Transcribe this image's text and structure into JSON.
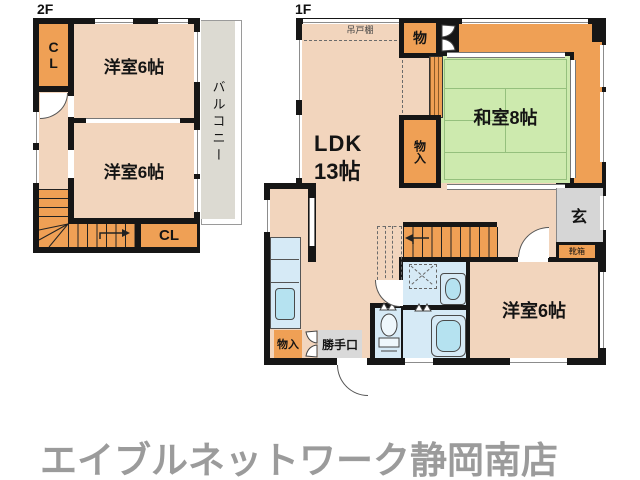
{
  "floor2": {
    "label": "2F",
    "closet_top": "CL",
    "room_top": "洋室6帖",
    "room_bottom": "洋室6帖",
    "closet_bottom": "CL",
    "balcony": "バルコニー"
  },
  "floor1": {
    "label": "1F",
    "ldk_name": "LDK",
    "ldk_size": "13帖",
    "hanging_cupboard": "吊戸棚",
    "storage_top": "物",
    "storage_mid": "物入",
    "japanese_room": "和室8帖",
    "entrance": "玄",
    "shoe_box": "靴箱",
    "western_room": "洋室6帖",
    "storage_bottom": "物入",
    "back_door": "勝手口"
  },
  "footer": {
    "store_name": "エイブルネットワーク静岡南店"
  },
  "colors": {
    "peach": "#f2d5bd",
    "orange": "#efa055",
    "green": "#cdeaae",
    "wall": "#161616",
    "gray-balcony": "#dcdad2",
    "gray-genkan": "#d6d6d6",
    "gray-door": "#d9d9d9",
    "blue": "#d6eaf6",
    "blue2": "#b5e2f0",
    "footer": "#9b9b9b",
    "tatami": "#95c07d"
  }
}
